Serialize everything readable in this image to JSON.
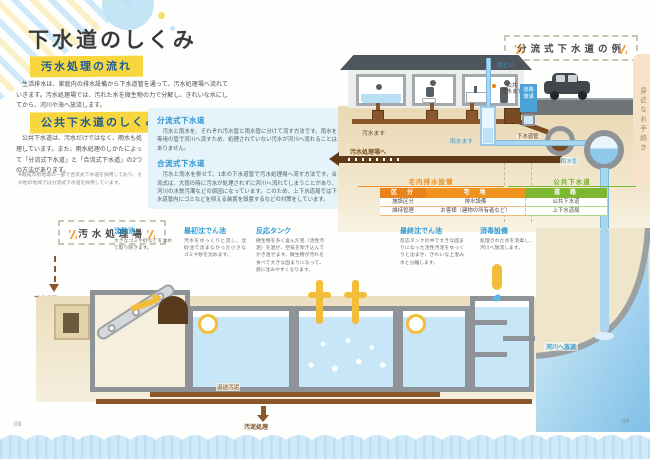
{
  "left_page": {
    "title": "下水道のしくみ",
    "page_number": "03",
    "flow_section": {
      "heading": "汚水処理の流れ",
      "body": "　生活排水は、家庭内の排水設備から下水道管を通って、汚水処理場へ流れていきます。汚水処理場では、汚れた水を微生物の力で分解し、きれいな水にしてから、河川や海へ放流します。"
    },
    "public_section": {
      "heading": "公共下水道のしくみ",
      "body": "　公共下水道は、汚水だけではなく、雨水も処理しています。また、雨水処理のしかたによって「分流式下水道」と「合流式下水道」の2つの方法があります。",
      "note": "※既成市街地等の一部で合流式下水道を採用しており、その他の地域では分流式下水道を採用しています。"
    },
    "types_box": {
      "separate_title": "分流式下水道",
      "separate_body": "　汚水と雨水を、それぞれ汚水管と雨水管に分けて流す方法です。雨水を専用の管で河川へ流すため、処理されていない汚水が河川へ流れることはありません。",
      "combined_title": "合流式下水道",
      "combined_body": "　汚水と雨水を併せて、1本の下水道管で汚水処理場へ流す方法です。合流式は、大雨の時に汚水が処理されずに河川へ流れてしまうことがあり、河川の水質汚濁などの原因になっています。このため、上下水道局では下水道管内にゴミなどを抑える装置を設置するなどの対策をしています。"
    }
  },
  "right_page": {
    "page_number": "04",
    "side_tab": "身近なお手続き",
    "example_title": "分流式下水道の例",
    "labels": {
      "rain_gutter": "雨どい",
      "public_sewage_basin": "公共\n汚水ます",
      "road_gutter": "道路\n側溝",
      "sewage_basin": "汚水ます",
      "rain_basin": "雨水ます",
      "sewer_pipe": "下水道管",
      "rain_pipe": "雨水管",
      "to_treatment_plant": "汚水処理場へ"
    },
    "spans": {
      "private": "宅内排水設備",
      "public": "公共下水道"
    },
    "table": {
      "headers": [
        "区　分",
        "宅　地",
        "道　路"
      ],
      "rows": [
        {
          "label": "施設区分",
          "private": "排水設備",
          "public": "公共下水道"
        },
        {
          "label": "維持管理",
          "private": "お客様（建物の所有者など）",
          "public": "上下水道局"
        }
      ]
    }
  },
  "plant": {
    "title": "汚水処理場",
    "inlet_label": "下水道管",
    "stages": [
      {
        "name": "沈砂池",
        "desc": "大きなゴミや砂などを沈めて取り除きます。"
      },
      {
        "name": "最初沈でん池",
        "desc": "汚水をゆっくりと流し、沈砂池で沈まなかった小さなゴミや砂を沈めます。"
      },
      {
        "name": "反応タンク",
        "desc": "微生物を多く含んだ泥（活性汚泥）を混ぜ、空気を吹き込んでかき混ぜます。微生物が汚れを食べて大きな固まりになって、底に沈みやすくなります。"
      },
      {
        "name": "最終沈でん池",
        "desc": "反応タンクの中で大きな固まりになった活性汚泥をゆっくりと沈ませ、きれいな上澄み水と分離します。"
      },
      {
        "name": "消毒設備",
        "desc": "処理された水を消毒し、河川へ放流します。"
      }
    ],
    "return_sludge": "返送汚泥",
    "sludge_treatment": "汚泥処理",
    "discharge": "河川へ放流"
  }
}
